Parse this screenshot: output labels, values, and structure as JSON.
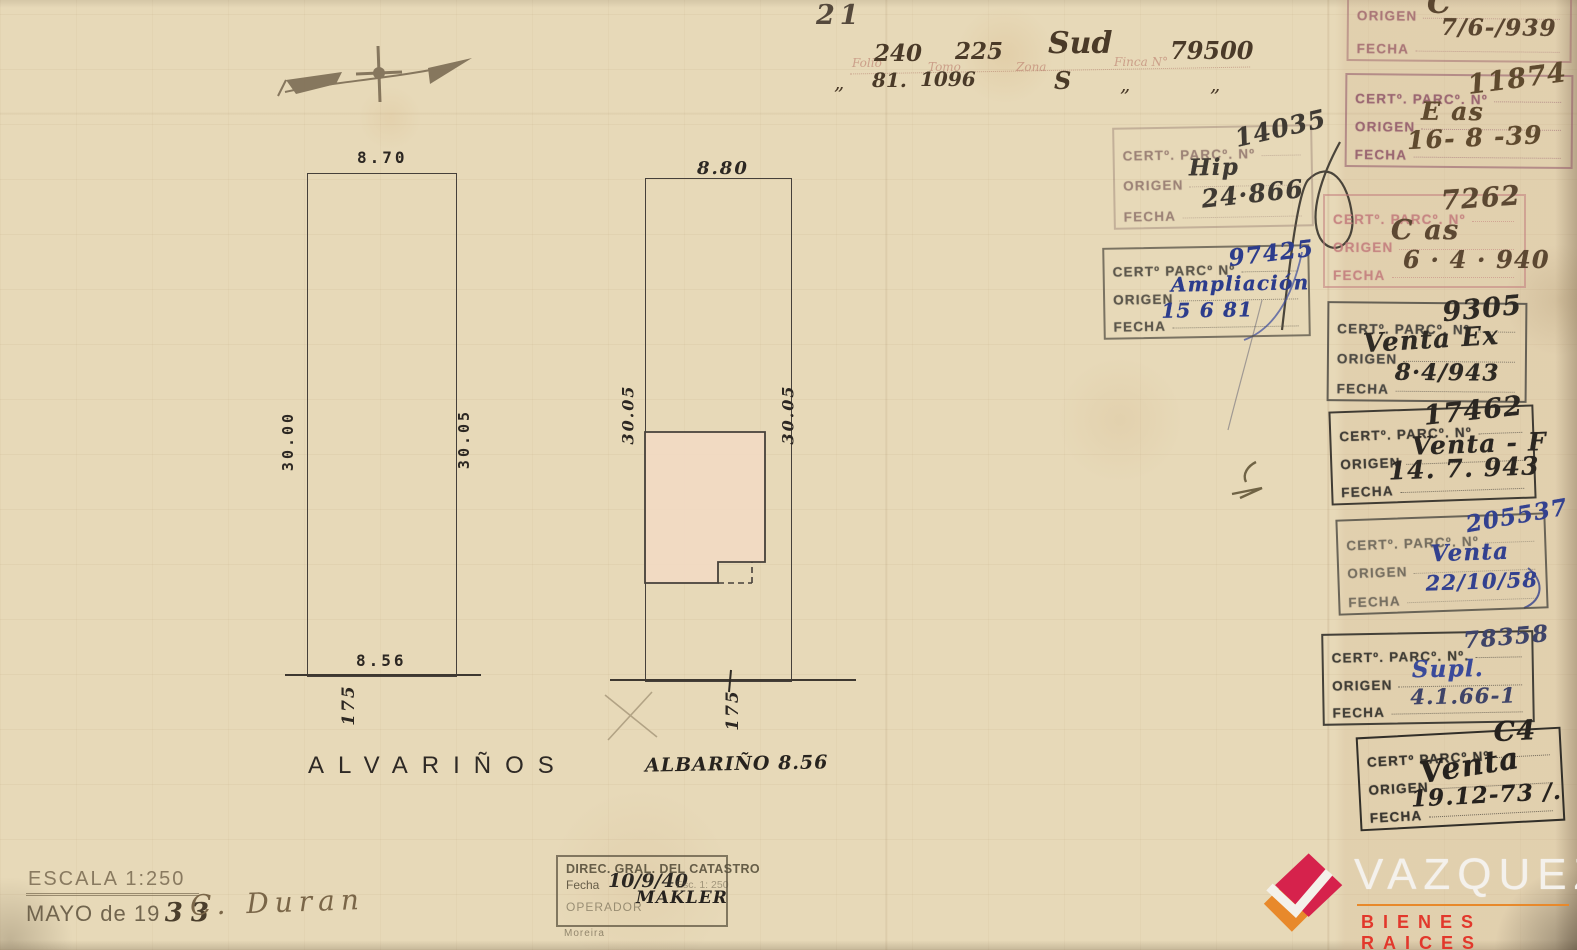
{
  "page": {
    "number": "21"
  },
  "form": {
    "labels": {
      "folio": "Folio",
      "tomo": "Tomo",
      "zona": "Zona",
      "finca": "Finca N°"
    },
    "values": {
      "folio": "240",
      "tomo": "225",
      "zona": "Sud",
      "finca": "79500"
    },
    "ditto": {
      "mark": "„",
      "folio": "81.",
      "tomo": "1096",
      "zona": "S",
      "finca": "„"
    }
  },
  "plan": {
    "left": {
      "top": "8.70",
      "side_left": "30.00",
      "side_right": "30.05",
      "bottom": "8.56",
      "frontage": "175",
      "street": "ALVARIÑOS"
    },
    "right": {
      "top": "8.80",
      "side_left": "30.05",
      "side_right": "30.05",
      "frontage": "175",
      "street_note": "ALBARIÑO 8.56"
    }
  },
  "scale": {
    "escala": "ESCALA 1:250",
    "month": "MAYO de 19",
    "year": "33",
    "signature": "C. Duran"
  },
  "catastro": {
    "title": "DIREC. GRAL. DEL CATASTRO",
    "fecha_label": "Fecha",
    "fecha_value": "10/9/40",
    "esc_note": "Esc. 1: 250",
    "operador_label": "OPERADOR",
    "operador_value": "MAKLER",
    "pencil_note": "Moreira"
  },
  "center_stamps": [
    {
      "cert_label": "CERTº. PARCº. Nº",
      "cert_value": "14035",
      "origen_label": "ORIGEN",
      "origen_value": "Hip",
      "fecha_label": "FECHA",
      "fecha_value": "24·866"
    },
    {
      "cert_label": "CERTº PARCº Nº",
      "cert_value": "97425",
      "origen_label": "ORIGEN",
      "origen_value": "Ampliación",
      "fecha_label": "FECHA",
      "fecha_value": "15  6  81"
    }
  ],
  "right_stamps": [
    {
      "cert_label": "CERTº. PARCº. Nº",
      "cert_value": "Orl",
      "origen_label": "ORIGEN",
      "origen_value": "C",
      "fecha_label": "FECHA",
      "fecha_value": "7/6-/939"
    },
    {
      "cert_label": "CERTº. PARCº. Nº",
      "cert_value": "11874",
      "origen_label": "ORIGEN",
      "origen_value": "E  as",
      "fecha_label": "FECHA",
      "fecha_value": "16- 8 -39"
    },
    {
      "cert_label": "CERTº. PARCº. Nº",
      "cert_value": "7262",
      "origen_label": "ORIGEN",
      "origen_value": "C  as",
      "fecha_label": "FECHA",
      "fecha_value": "6 · 4 · 940"
    },
    {
      "cert_label": "CERTº. PARCº. Nº",
      "cert_value": "9305",
      "origen_label": "ORIGEN",
      "origen_value": "Venta  Ex",
      "fecha_label": "FECHA",
      "fecha_value": "8·4/943"
    },
    {
      "cert_label": "CERTº. PARCº. Nº",
      "cert_value": "17462",
      "origen_label": "ORIGEN",
      "origen_value": "Venta - F",
      "fecha_label": "FECHA",
      "fecha_value": "14. 7. 943"
    },
    {
      "cert_label": "CERTº. PARCº. Nº",
      "cert_value": "205537",
      "origen_label": "ORIGEN",
      "origen_value": "Venta",
      "fecha_label": "FECHA",
      "fecha_value": "22/10/58"
    },
    {
      "cert_label": "CERTº. PARCº. Nº.",
      "cert_value": "78358",
      "origen_label": "ORIGEN",
      "origen_value": "Supl.",
      "fecha_label": "FECHA",
      "fecha_value": "4.1.66-1"
    },
    {
      "cert_label": "CERTº PARCº Nº",
      "cert_value": "C4",
      "origen_label": "ORIGEN",
      "origen_value": "Venta",
      "fecha_label": "FECHA",
      "fecha_value": "19.12-73 /."
    }
  ],
  "logo": {
    "name": "VAZQUEZ",
    "tagline": "BIENES RAICES",
    "orange": "#E8892B",
    "red": "#D6224C",
    "tagline_red": "#E2382C"
  }
}
